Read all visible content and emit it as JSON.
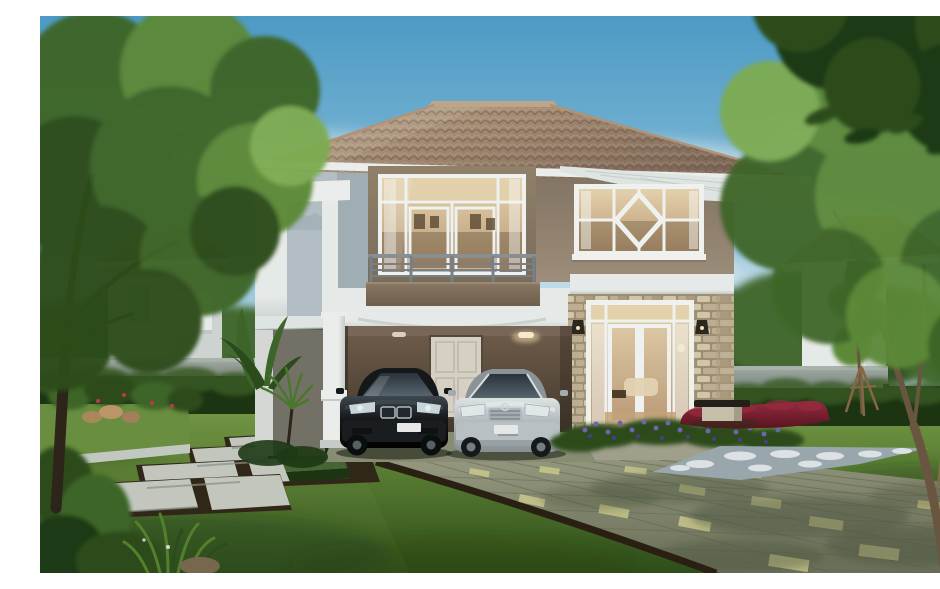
{
  "scene": {
    "type": "architectural-rendering",
    "description": "Daytime 3D rendering of a two-storey suburban house with a hipped terracotta tile roof, upper balcony with french windows, diamond-pattern feature window, stone-clad entrance with glazed double doors, and a carport sheltering a black sedan and a silver sedan. The garden has a green lawn, a paved driveway, a stepping-stone path, trimmed hedges, purple flower beds, a white gravel strip, a red-leaf hedge, a bench and a staked sapling, all framed by large trees and neighbouring tile-roofed houses under a blue sky.",
    "objects": [
      "sky",
      "clouds",
      "background-trees",
      "neighbor-house-left",
      "neighbor-house-right",
      "boundary-wall",
      "garden-fence",
      "hedge",
      "main-house",
      "hip-tile-roof",
      "upper-balcony",
      "balcony-french-windows",
      "diamond-feature-window",
      "white-floor-band",
      "stone-clad-entrance",
      "entrance-french-doors",
      "wall-sconces",
      "carport",
      "carport-rear-door",
      "carport-pillar",
      "black-sedan",
      "silver-sedan",
      "front-lawn",
      "paved-driveway",
      "stepping-stone-path",
      "trimmed-hedge-blocks",
      "raised-planter",
      "purple-flower-bed",
      "gravel-bed",
      "red-leaf-hedge",
      "garden-bench",
      "staked-sapling",
      "banana-plant",
      "foreground-tree-left",
      "foreground-tree-right",
      "overhanging-branch-top-right"
    ]
  },
  "palette": {
    "sky_top": "#4f9fce",
    "sky_mid": "#93c6e2",
    "sky_low": "#dceef5",
    "cloud": "#ffffff",
    "foliage_dark": "#1e3a16",
    "foliage_deep": "#2d4d1f",
    "foliage_mid": "#40682b",
    "foliage_light": "#5f8d3a",
    "foliage_pale": "#82b055",
    "trunk_dark": "#2e251b",
    "trunk_mid": "#6d5843",
    "trunk_light": "#8a7158",
    "roof_hi": "#c7ab8e",
    "roof_lo": "#80675a",
    "roof_line": "#62503f",
    "roof_ridge": "#c3aa8e",
    "fascia": "#f3f5f5",
    "soffit": "#e7eceb",
    "soffit_line": "#c9d2d2",
    "wall_white": "#eef1f1",
    "band_lo": "#ccd2d3",
    "bay_front": "#b9c4cb",
    "bay_side": "#a0aeb7",
    "wall_grey": "#a6b2ba",
    "surround_hi": "#95846f",
    "surround_lo": "#7e6e5f",
    "taupe_hi": "#a3917f",
    "taupe_lo": "#857566",
    "glass_hi": "#ecd8b4",
    "glass_lo": "#bf9d79",
    "mullion": "#f7f9f8",
    "interior": "#54422f",
    "panel_hi": "#8f7c6a",
    "panel_lo": "#6f5d4c",
    "rail": "#7a848c",
    "stone_bg": "#a29274",
    "stone_a": "#d8ccb3",
    "stone_b": "#c4b499",
    "stone_c": "#b19f83",
    "carport_hi": "#74604f",
    "carport_lo": "#3a2f26",
    "door_cream": "#ddd7cb",
    "pillar_hi": "#f3f5f4",
    "pillar_lo": "#ccd2d2",
    "car1_hi": "#3f4852",
    "car1_lo": "#15171b",
    "car2_hi": "#e6eaec",
    "car2_lo": "#a9b0b7",
    "car_glass_hi": "#5d6b78",
    "car_glass_lo": "#2b333d",
    "chrome": "#b6bfc5",
    "plate": "#edeff0",
    "lawn_hi": "#7da14c",
    "lawn_mid": "#5a7e34",
    "lawn_lo": "#2f4f1b",
    "drive_hi": "#9a9d85",
    "drive_lo": "#6f735d",
    "drive_line": "#62664f",
    "drive_tile": "#d6d294",
    "curb": "#2a2014",
    "slab": "#c9cdc5",
    "slab_lo": "#8f958f",
    "soil": "#32271b",
    "hedge_hi": "#3b5d27",
    "hedge_lo": "#1e3513",
    "wallc_hi": "#a0aaa4",
    "wallc_lo": "#6e7973",
    "fence": "#232a25",
    "red_hi": "#9e2b43",
    "red_lo": "#5a1322",
    "purple": "#7165b7",
    "purple_dk": "#474090",
    "gravel_hi": "#e4eaed",
    "gravel_lo": "#9fabb3",
    "bench_top": "#23201b",
    "bench_base": "#ccc5b1",
    "shadow_grn": "#223813",
    "drive_shdw": "#4c5540",
    "glow": "#ffe9b8"
  }
}
